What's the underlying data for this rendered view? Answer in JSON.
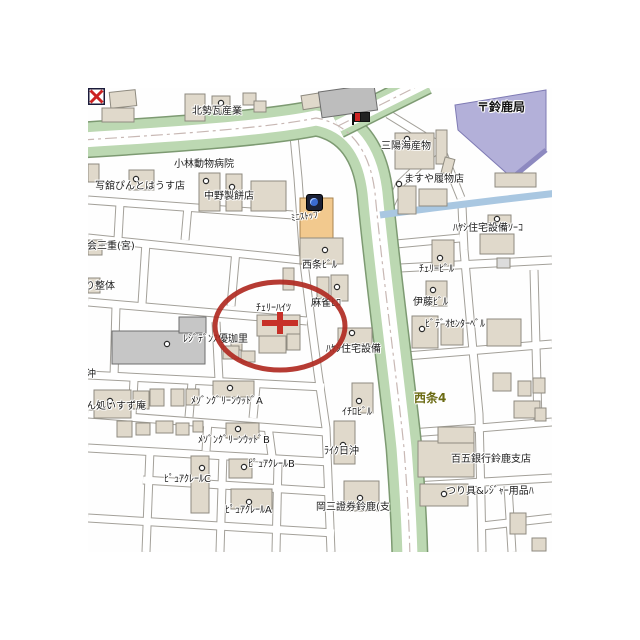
{
  "map": {
    "region_name": "西条4",
    "marker": {
      "type": "red-circle-with-cross",
      "highlighted_place": "ﾁｪﾘｰﾊｲﾂ"
    },
    "labels": [
      {
        "id": "hokusei-kawara",
        "text": "北勢瓦産業",
        "x": 104,
        "y": 18
      },
      {
        "id": "kobayashi-animal-hospital",
        "text": "小林動物病院",
        "x": 86,
        "y": 71
      },
      {
        "id": "photo-pinto-house",
        "text": "写舘ぴんとはうす店",
        "x": 7,
        "y": 93
      },
      {
        "id": "nakano-seihei",
        "text": "中野製餅店",
        "x": 116,
        "y": 103
      },
      {
        "id": "ministop",
        "text": "ﾐﾆｽﾄｯﾌﾟ",
        "x": 203,
        "y": 124,
        "cls": "slant"
      },
      {
        "id": "sanyo-kaisanbutsu",
        "text": "三陽海産物",
        "x": 293,
        "y": 53
      },
      {
        "id": "masuya-hakimono",
        "text": "ますや履物店",
        "x": 316,
        "y": 86
      },
      {
        "id": "suzuka-post-office",
        "text": "〒鈴鹿局",
        "x": 389,
        "y": 14,
        "cls": "bold-black"
      },
      {
        "id": "hayashi-soko",
        "text": "ﾊﾔｼ住宅設備ｿｰｺ",
        "x": 365,
        "y": 135
      },
      {
        "id": "cherry-biru",
        "text": "ﾁｪﾘｰﾋﾞﾙ",
        "x": 331,
        "y": 176
      },
      {
        "id": "saijo-biru",
        "text": "西条ﾋﾞﾙ",
        "x": 214,
        "y": 172
      },
      {
        "id": "mahjong-hiro",
        "text": "麻雀ﾋﾛ",
        "x": 223,
        "y": 210
      },
      {
        "id": "ito-biru",
        "text": "伊藤ﾋﾞﾙ",
        "x": 325,
        "y": 209
      },
      {
        "id": "video-center-bell",
        "text": "ﾋﾞﾃﾞｵｾﾝﾀｰﾍﾞﾙ",
        "x": 337,
        "y": 231
      },
      {
        "id": "cherry-heights",
        "text": "ﾁｪﾘｰﾊｲﾂ",
        "x": 168,
        "y": 215
      },
      {
        "id": "hayashi-jutaku",
        "text": "ﾊﾔｼ住宅設備",
        "x": 238,
        "y": 256
      },
      {
        "id": "residence-yukari",
        "text": "ﾚｼﾞﾃﾞﾝｽ優珈里",
        "x": 95,
        "y": 246
      },
      {
        "id": "shokai-mie",
        "text": "商会三重(宮)",
        "x": -11,
        "y": 153
      },
      {
        "id": "ri-seitai",
        "text": "り整体",
        "x": -3,
        "y": 193
      },
      {
        "id": "hioki",
        "text": "日沖",
        "x": -12,
        "y": 281
      },
      {
        "id": "isuzu-an",
        "text": "ごはん処いすず庵",
        "x": -22,
        "y": 313
      },
      {
        "id": "maison-greenwood-a",
        "text": "ﾒｿﾞﾝｸﾞﾘｰﾝｳｯﾄﾞA",
        "x": 103,
        "y": 308
      },
      {
        "id": "maison-greenwood-b",
        "text": "ﾒｿﾞﾝｸﾞﾘｰﾝｳｯﾄﾞB",
        "x": 110,
        "y": 347
      },
      {
        "id": "pure-claire-c",
        "text": "ﾋﾟｭｱｸﾚｰﾙC",
        "x": 76,
        "y": 386
      },
      {
        "id": "pure-claire-b",
        "text": "ﾋﾟｭｱｸﾚｰﾙB",
        "x": 160,
        "y": 371
      },
      {
        "id": "pure-claire-a",
        "text": "ﾋﾟｭｱｸﾚｰﾙA",
        "x": 137,
        "y": 417
      },
      {
        "id": "okasan-shoken",
        "text": "岡三證券鈴鹿(支",
        "x": 228,
        "y": 414
      },
      {
        "id": "ichiro-biru",
        "text": "ｲﾁﾛﾋﾞﾙ",
        "x": 254,
        "y": 319
      },
      {
        "id": "like-hioki",
        "text": "ﾗｲｸ日沖",
        "x": 236,
        "y": 358
      },
      {
        "id": "saijo-4",
        "text": "西条4",
        "x": 326,
        "y": 305,
        "cls": "district"
      },
      {
        "id": "hyakugo-bank",
        "text": "百五銀行鈴鹿支店",
        "x": 363,
        "y": 366
      },
      {
        "id": "fishing-leisure",
        "text": "つり具&ﾚｼﾞｬｰ用品ﾊ",
        "x": 358,
        "y": 398
      }
    ],
    "icons": [
      {
        "name": "convenience-store-icon"
      },
      {
        "name": "flag-icon"
      },
      {
        "name": "bank-icon"
      },
      {
        "name": "post-office-mark"
      }
    ],
    "colors": {
      "road_green": "#bcd8b2",
      "road_green_edge": "#7d9a72",
      "river_blue": "#a9c7e1",
      "building_beige": "#e0d9cb",
      "building_gray": "#c6c6c6",
      "post_office_purple": "#b3b0d9",
      "ministop_building_orange": "#f2c98e",
      "marker_red": "#b02a22",
      "district_label_olive": "#6b6b14"
    }
  }
}
